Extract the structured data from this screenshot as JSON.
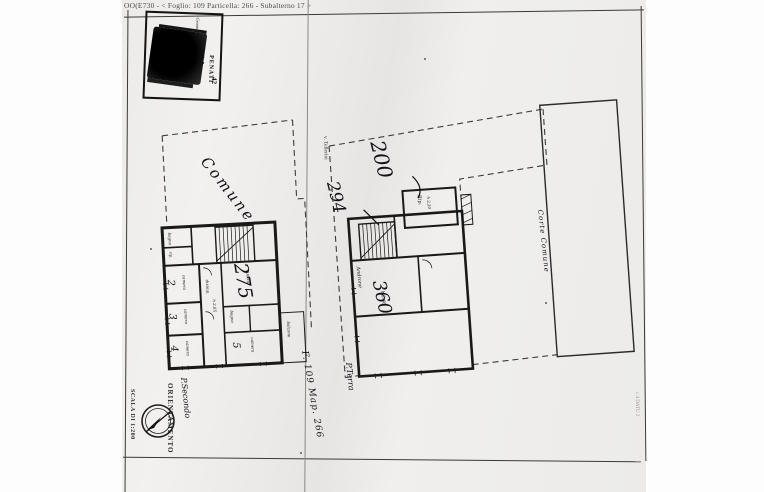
{
  "document": {
    "header": "OO(E730 - < Foglio: 109 Particella: 266 - Subalterno 17 >"
  },
  "stamp": {
    "org_fragment": "Geometri",
    "line_na": "N A",
    "line_penati": "PENATI",
    "line_num": "42"
  },
  "left_plan": {
    "area_label": "Comune",
    "big_number": "275",
    "rooms": {
      "r2": "2",
      "r2_name": "camera",
      "r3": "3",
      "r3_name": "camera",
      "r4": "4",
      "r4_name": "camera",
      "r5": "5",
      "r5_name": "camera",
      "kitchen": "cucina",
      "bath_top": "bagno",
      "storage_top": "rip.",
      "bath_mid": "bagno",
      "hall": "disimp.",
      "height": "h 2.85",
      "balcony": "balcone"
    }
  },
  "right_plan": {
    "street": "v. Tellerini",
    "courtyard": "Corte Comune",
    "num_200": "200",
    "num_294": "294",
    "num_360": "360",
    "storage": "Rip.",
    "storage_height": "h 2.20",
    "entrance_hall": "Androne",
    "height": "h 2.60",
    "floor_label": "P.Terra",
    "map_ref": "F. 109 Map. 266"
  },
  "footer": {
    "floor_label": "P.Secondo",
    "orientation_label": "ORIENTAMENTO",
    "scale_label": "SCALA DI 1:200",
    "edge_note": "c 4 DATU 2"
  }
}
